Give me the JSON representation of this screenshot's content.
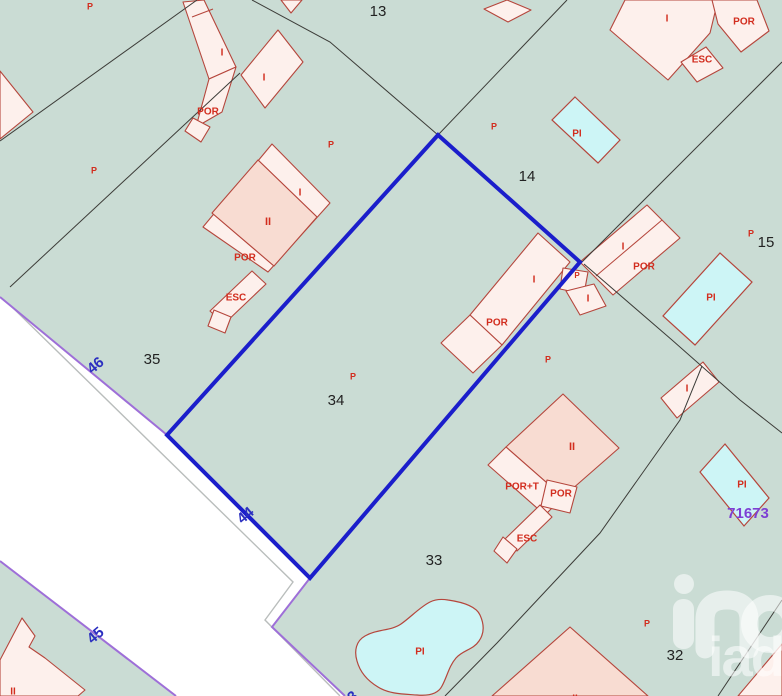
{
  "map": {
    "colors": {
      "background": "#cadcd4",
      "road_fill": "#ffffff",
      "road_edge": "#9e6fd8",
      "road_inner": "#b9bdbc",
      "building_fill": "#fdf0ec",
      "building_fill_dark": "#f8dcd2",
      "building_border": "#b5463c",
      "pool_fill": "#cdf5f6",
      "boundary_line": "#3c3c38",
      "highlight": "#1b1ecb",
      "label_red": "#d22d1e",
      "label_black": "#222222",
      "road_number_blue": "#2b2fc0",
      "ref_purple": "#7d3fd4"
    },
    "roads": {
      "main_polygon": "0,297 167,435 310,578 272,627 345,696 176,696 0,561",
      "purple_edges": [
        "0,297 167,435 310,578 272,627 345,696",
        "0,561 176,696"
      ],
      "inner_lines": [
        "10,305 293,582 265,620 340,696"
      ]
    },
    "highlight_parcel": {
      "points": "438,135 580,262 310,578 167,435"
    },
    "boundary_lines": [
      "0,141 197,0",
      "240,73 10,287",
      "252,0 330,42 438,135",
      "567,0 438,135",
      "782,62 582,262",
      "584,264 672,340 740,400 782,433",
      "702,366 680,420 600,533 497,643 445,696",
      "782,600 718,696"
    ],
    "buildings": [
      {
        "points": "183,2 204,0 236,67 209,79",
        "inner": [
          "192,17 213,9"
        ]
      },
      {
        "points": "209,79 236,67 222,112 196,127"
      },
      {
        "points": "193,118 210,127 201,142 185,131"
      },
      {
        "points": "278,30 303,62 265,108 241,75"
      },
      {
        "points": "281,0 302,0 291,13"
      },
      {
        "points": "0,71 33,112 0,139"
      },
      {
        "points": "272,144 330,203 268,272 203,227",
        "inner": [
          "258,160 317,217",
          "212,213 274,266"
        ]
      },
      {
        "points": "258,160 317,217 274,266 212,213",
        "dark": true
      },
      {
        "points": "252,271 266,284 224,324 210,311"
      },
      {
        "points": "214,310 231,317 225,333 208,326"
      },
      {
        "points": "470,315 538,233 570,262 502,345"
      },
      {
        "points": "470,315 502,345 473,373 441,343"
      },
      {
        "points": "563,268 588,272 584,294 560,289"
      },
      {
        "points": "566,291 594,284 606,306 580,315"
      },
      {
        "points": "580,262 647,205 680,238 613,295",
        "inner": [
          "596,276 662,220"
        ]
      },
      {
        "points": "625,0 718,0 710,33 668,80 610,30"
      },
      {
        "points": "712,0 757,0 769,31 741,52 718,24"
      },
      {
        "points": "681,62 706,47 723,68 697,82"
      },
      {
        "points": "703,362 719,382 677,418 661,398"
      },
      {
        "points": "738,696 782,644 782,696"
      },
      {
        "points": "0,660 22,618 35,636 29,647 45,658 85,690 78,696 0,696"
      },
      {
        "points": "563,394 619,448 563,497 506,447",
        "dark": true
      },
      {
        "points": "506,447 563,497 545,515 488,465"
      },
      {
        "points": "547,480 577,487 570,513 541,506"
      },
      {
        "points": "540,505 552,517 517,551 505,539"
      },
      {
        "points": "503,537 517,549 507,563 494,551"
      },
      {
        "points": "570,627 648,696 492,696",
        "dark": true
      },
      {
        "points": "484,9 507,0 531,10 508,22"
      }
    ],
    "pools": [
      {
        "points": "575,97 620,140 598,163 552,120"
      },
      {
        "points": "720,253 752,282 695,345 663,316"
      },
      {
        "points": "725,444 769,498 744,526 700,472"
      },
      {
        "path": "M448,600 C462,602 476,606 480,615 C485,626 484,634 479,641 C473,650 463,650 456,658 C449,666 447,677 442,686 C438,694 428,696 417,695 C403,694 389,694 378,687 C368,681 360,672 357,661 C354,651 356,641 365,636 C377,629 391,631 401,624 C411,617 420,607 430,602 C436,599 442,599 448,600 Z"
      }
    ],
    "red_labels": [
      {
        "text": "P",
        "x": 90,
        "y": 7,
        "size": 9
      },
      {
        "text": "P",
        "x": 94,
        "y": 171,
        "size": 9
      },
      {
        "text": "I",
        "x": 222,
        "y": 53,
        "size": 10
      },
      {
        "text": "POR",
        "x": 208,
        "y": 112,
        "size": 10
      },
      {
        "text": "I",
        "x": 264,
        "y": 78,
        "size": 10
      },
      {
        "text": "P",
        "x": 331,
        "y": 145,
        "size": 9
      },
      {
        "text": "I",
        "x": 300,
        "y": 193,
        "size": 10
      },
      {
        "text": "II",
        "x": 268,
        "y": 222,
        "size": 11
      },
      {
        "text": "POR",
        "x": 245,
        "y": 258,
        "size": 10
      },
      {
        "text": "ESC",
        "x": 236,
        "y": 298,
        "size": 10
      },
      {
        "text": "P",
        "x": 353,
        "y": 377,
        "size": 9
      },
      {
        "text": "P",
        "x": 494,
        "y": 127,
        "size": 9
      },
      {
        "text": "PI",
        "x": 577,
        "y": 134,
        "size": 10
      },
      {
        "text": "I",
        "x": 667,
        "y": 19,
        "size": 10
      },
      {
        "text": "POR",
        "x": 744,
        "y": 22,
        "size": 10
      },
      {
        "text": "ESC",
        "x": 702,
        "y": 60,
        "size": 10
      },
      {
        "text": "P",
        "x": 751,
        "y": 234,
        "size": 9
      },
      {
        "text": "I",
        "x": 623,
        "y": 247,
        "size": 10
      },
      {
        "text": "POR",
        "x": 644,
        "y": 267,
        "size": 10
      },
      {
        "text": "P",
        "x": 577,
        "y": 276,
        "size": 8
      },
      {
        "text": "I",
        "x": 534,
        "y": 280,
        "size": 10
      },
      {
        "text": "POR",
        "x": 497,
        "y": 323,
        "size": 10
      },
      {
        "text": "I",
        "x": 588,
        "y": 299,
        "size": 10
      },
      {
        "text": "PI",
        "x": 711,
        "y": 298,
        "size": 10
      },
      {
        "text": "I",
        "x": 687,
        "y": 389,
        "size": 10
      },
      {
        "text": "P",
        "x": 548,
        "y": 360,
        "size": 9
      },
      {
        "text": "II",
        "x": 572,
        "y": 447,
        "size": 11
      },
      {
        "text": "POR+T",
        "x": 522,
        "y": 487,
        "size": 10
      },
      {
        "text": "POR",
        "x": 561,
        "y": 494,
        "size": 10
      },
      {
        "text": "ESC",
        "x": 527,
        "y": 539,
        "size": 10
      },
      {
        "text": "PI",
        "x": 420,
        "y": 652,
        "size": 10
      },
      {
        "text": "P",
        "x": 647,
        "y": 624,
        "size": 9
      },
      {
        "text": "PI",
        "x": 742,
        "y": 485,
        "size": 10
      },
      {
        "text": "II",
        "x": 13,
        "y": 692,
        "size": 10
      },
      {
        "text": "II",
        "x": 575,
        "y": 699,
        "size": 10
      }
    ],
    "parcel_numbers": [
      {
        "text": "13",
        "x": 378,
        "y": 12
      },
      {
        "text": "14",
        "x": 527,
        "y": 177
      },
      {
        "text": "15",
        "x": 766,
        "y": 243
      },
      {
        "text": "35",
        "x": 152,
        "y": 360
      },
      {
        "text": "34",
        "x": 336,
        "y": 401
      },
      {
        "text": "33",
        "x": 434,
        "y": 561
      },
      {
        "text": "32",
        "x": 675,
        "y": 656
      }
    ],
    "road_numbers": [
      {
        "text": "46",
        "x": 96,
        "y": 366,
        "rotation": -40
      },
      {
        "text": "44",
        "x": 246,
        "y": 516,
        "rotation": -40
      },
      {
        "text": "45",
        "x": 96,
        "y": 636,
        "rotation": -40
      },
      {
        "text": "43",
        "x": 350,
        "y": 700,
        "rotation": -40
      }
    ],
    "ref_number": {
      "text": "71673",
      "x": 748,
      "y": 514
    },
    "watermark": {
      "text": "iad"
    }
  }
}
